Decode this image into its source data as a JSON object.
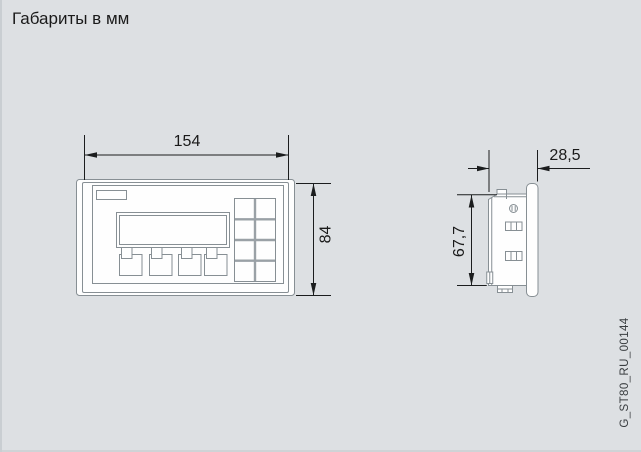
{
  "title": "Габариты в мм",
  "figure_id": "G_ST80_RU_00144",
  "dimensions": {
    "front_width_mm": "154",
    "front_height_mm": "84",
    "side_depth_mm": "28,5",
    "side_height_mm": "67,7"
  },
  "colors": {
    "background": "#dde0e3",
    "drawing_line": "#878f94",
    "keypad_divider": "#9aa1a6",
    "dimension_line": "#1b1d1e",
    "panel_fill": "#fefefe",
    "text": "#1a1a1a"
  }
}
